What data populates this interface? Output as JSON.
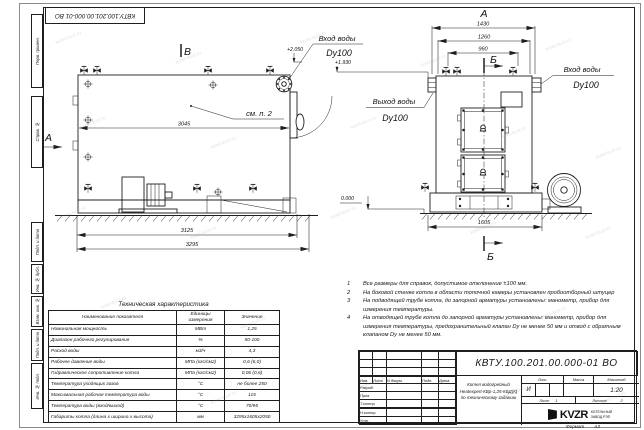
{
  "watermark": {
    "text": "kotel-kvzr.ru"
  },
  "corner_stamp": {
    "doc_number": "КВТУ.100.201.00.000-01 ВО"
  },
  "margin": {
    "perv_primen": "Перв. примен.",
    "sprav_no": "Справ. №",
    "podp_data1": "Подп. и дата",
    "inv_dubl": "Инв. № дубл.",
    "vzam_inv": "Взам. инв. №",
    "podp_data2": "Подп. и дата",
    "inv_podl": "Инв. № подл."
  },
  "side_view": {
    "view_mark": "В",
    "dir_mark": "А",
    "inlet_label": "Вход воды",
    "inlet_dn": "Dy100",
    "elev_inlet": "+2.050",
    "elev_outlet": "+1.930",
    "see_note": "см. п. 2",
    "dim_3045": "3045",
    "dim_3125": "3125",
    "dim_3295": "3295"
  },
  "front_view": {
    "view_mark": "А",
    "section_top": "Б",
    "section_bottom": "Б",
    "dim_1430": "1430",
    "dim_1260": "1260",
    "dim_960": "960",
    "dim_1605": "1605",
    "inlet_label": "Вход воды",
    "inlet_dn": "Dy100",
    "outlet_label": "Выход воды",
    "outlet_dn": "Dy100",
    "elev_zero": "0.000"
  },
  "notes": [
    {
      "num": "1",
      "text": "Все размеры для справок, допустимое отклонение ±100 мм."
    },
    {
      "num": "2",
      "text": "На боковой стенке котла в области топочной камеры установлен пробоотборный штуцер"
    },
    {
      "num": "3",
      "text": "На подводящей трубе котла, до запорной арматуры установлены: манометр, прибор для измерения температуры."
    },
    {
      "num": "4",
      "text": "На отводящей трубе котла до запорной арматуры установлены: манометр, прибор для измерения температуры, предохранительный клапан Dу не менее 50 мм и отвод с обратным клапаном Dу не менее 50 мм."
    }
  ],
  "tech_table": {
    "title": "Техническая характеристика",
    "headers": [
      "Наименование показателя",
      "Единицы измерения",
      "Значение"
    ],
    "rows": [
      [
        "Номинальная мощность",
        "МВт",
        "1,25"
      ],
      [
        "Диапазон рабочего регулирования",
        "%",
        "50-100"
      ],
      [
        "Расход воды",
        "м3/ч",
        "4,3"
      ],
      [
        "Рабочее давление воды",
        "МПа (кгс/см2)",
        "0,6 (6,0)"
      ],
      [
        "Гидравлическое сопротивление котла",
        "МПа (кгс/см2)",
        "0,06 (0,6)"
      ],
      [
        "Температура уходящих газов",
        "°С",
        "не более 250"
      ],
      [
        "Максимальная рабочая температура воды",
        "°С",
        "115"
      ],
      [
        "Температура воды (вход/выход)",
        "°С",
        "70/95"
      ],
      [
        "Габариты котла (длина х ширина х высота)",
        "мм",
        "3295х1605х2050"
      ]
    ]
  },
  "title_block": {
    "doc_number": "КВТУ.100.201.00.000-01 ВО",
    "name_line1": "Котел водогрейный",
    "name_line2": "Heatexpert-КВр-1,25-КБД(К)",
    "name_line3": "по техническому заданию",
    "col_izm": "Изм.",
    "col_list": "Лист",
    "col_ndok": "N докум.",
    "col_podp": "Подп.",
    "col_data": "Дата",
    "row_razrab": "Разраб.",
    "row_prov": "Пров.",
    "row_tkontr": "Т.контр.",
    "row_nkontr": "Н.контр.",
    "row_utv": "Утв.",
    "lit_label": "Лит.",
    "massa_label": "Масса",
    "scale_label": "Масштаб",
    "lit_value": "И",
    "scale_value": "1:20",
    "sheet_label": "Лист",
    "sheet_value": "1",
    "sheets_label": "Листов",
    "sheets_value": "2",
    "logo_text": "KVZR",
    "logo_sub1": "КОТЕЛЬНЫЙ",
    "logo_sub2": "ЗАВОД РЭП",
    "format_label": "Формат",
    "format_value": "А3"
  }
}
